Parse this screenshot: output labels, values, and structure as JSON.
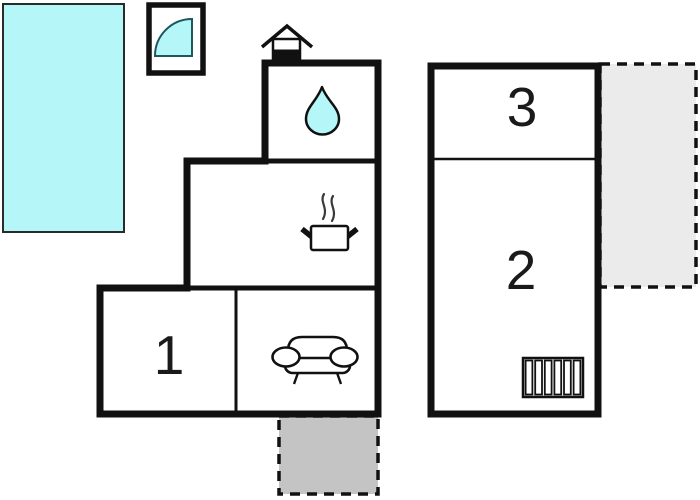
{
  "floorplan": {
    "rooms": [
      {
        "number": "1"
      },
      {
        "number": "2"
      },
      {
        "number": "3"
      }
    ],
    "features": {
      "pool": "swimming-pool",
      "window_box": "corner-bath-window",
      "fireplace": "fireplace-chimney-icon",
      "bathroom": "water-drop-icon",
      "kitchen": "cooking-pot-icon",
      "living_room": "sofa-icon",
      "room_2_fixture": "radiator-icon",
      "terraces": [
        "terrace-right",
        "terrace-bottom"
      ]
    },
    "colors": {
      "water": "#b5f6f8",
      "wall": "#111111",
      "terrace_right_fill": "#ebebeb",
      "terrace_bottom_fill": "#c4c4c4"
    }
  }
}
